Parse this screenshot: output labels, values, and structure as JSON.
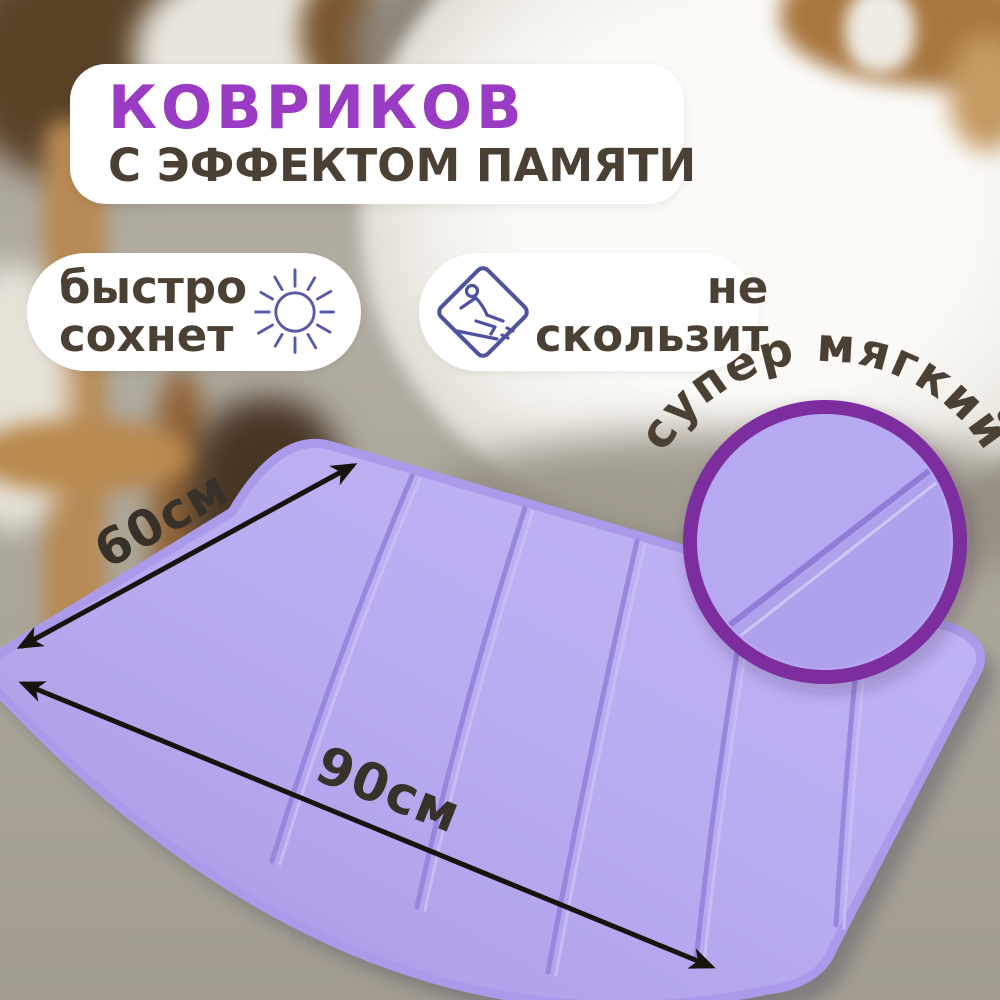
{
  "header": {
    "title": "КОВРИКОВ",
    "subtitle": "С ЭФФЕКТОМ ПАМЯТИ"
  },
  "features": [
    {
      "id": "fast-dry",
      "lines": [
        "быстро",
        "сохнет"
      ],
      "icon": "sun-icon"
    },
    {
      "id": "non-slip",
      "lines": [
        "не",
        "скользит"
      ],
      "icon": "slip-warning-icon"
    }
  ],
  "inset": {
    "caption": "супер мягкий"
  },
  "dimensions": {
    "width": "60см",
    "length": "90см"
  },
  "scene_description": {
    "product": "lavender memory-foam bath mat with stitched channels",
    "background": "blurred bathroom with white bathtub, wooden ladder shelf and towels"
  },
  "colors": {
    "title_purple": "#9a3bc4",
    "text_brown": "#4b4034",
    "icon_indigo": "#5257a3",
    "ring_purple": "#7c2e9e",
    "mat_lavender": "#b6a7ef",
    "mat_seam": "#9483da",
    "arrow_black": "#17140f",
    "card_white": "#ffffff",
    "floor_gray": "#aba69a"
  }
}
